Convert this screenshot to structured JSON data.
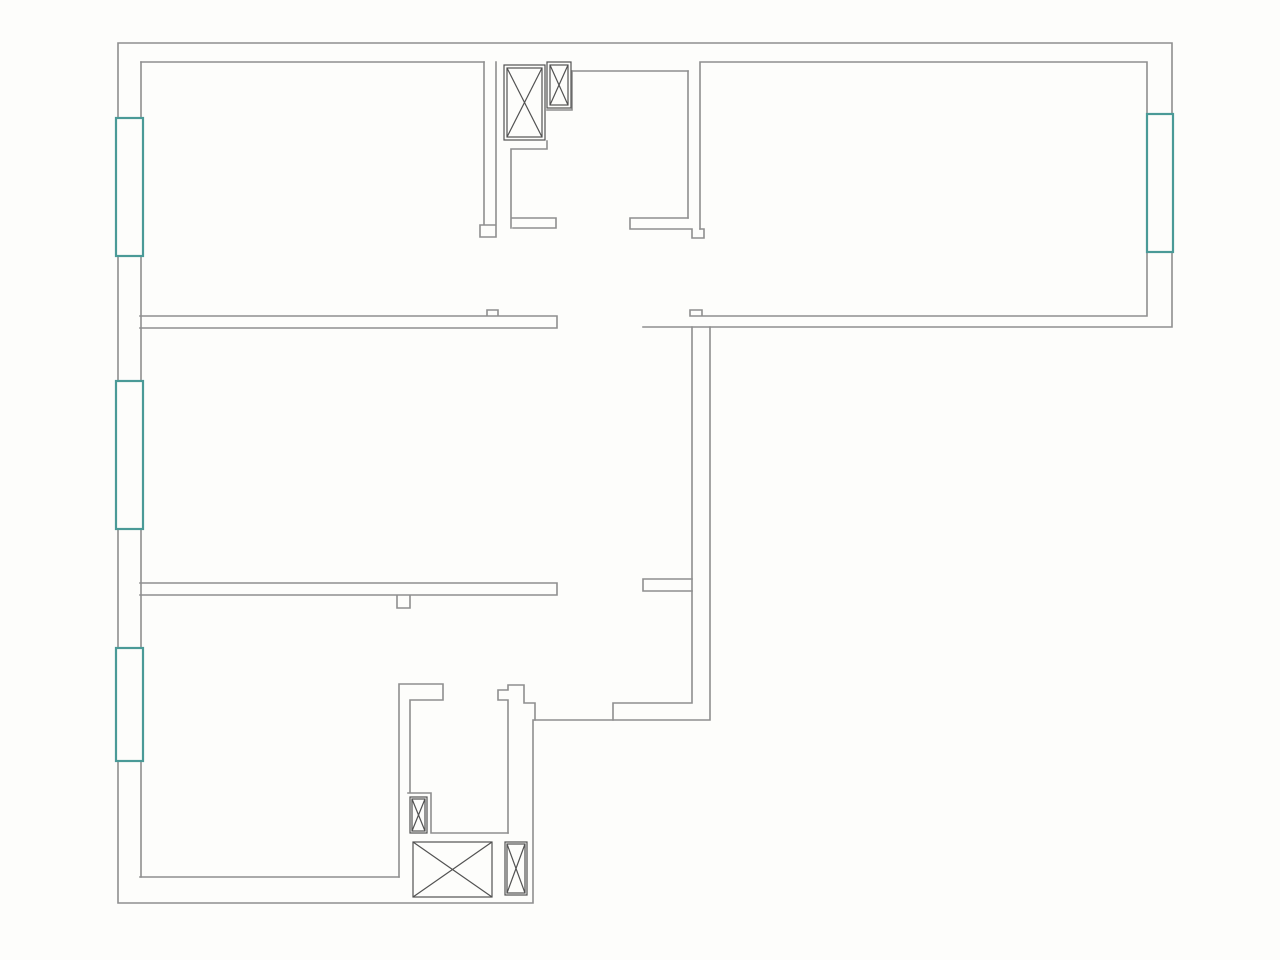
{
  "floorplan": {
    "title": "apartment-floor-plan",
    "canvas": {
      "width": 1280,
      "height": 960
    },
    "colors": {
      "background": "#fdfdfb",
      "wall": "#8f8f8f",
      "detail": "#525252",
      "window": "#4a9a97",
      "window_fill": "#fdfdfb"
    },
    "stroke_widths": {
      "wall": 1.6,
      "detail": 1.2,
      "window": 2.2
    },
    "outline": {
      "name": "apartment-outline",
      "d": "M118,43 L1172,43 L1172,327 L710,327 L710,720 L533,720 L533,903 L118,903 Z"
    },
    "walls": [
      {
        "name": "left-inner-wall",
        "d": "M141,62 L141,877"
      },
      {
        "name": "top-left-room-top-wall",
        "d": "M141,62 L484,62"
      },
      {
        "name": "top-left-room-right-wall",
        "d": "M484,62 L484,225 M496,62 L496,225 M496,225 L480,225 L480,237 L496,237 L496,225"
      },
      {
        "name": "wall-band-topleft-middle",
        "d": "M140,316 L557,316 M140,328 L557,328 M557,316 L557,328 M487,316 L487,310 L498,310 L498,316"
      },
      {
        "name": "wall-band-middle-bottom",
        "d": "M140,583 L557,583 M140,595 L557,595 M557,583 L557,595 M397,595 L397,608 L410,608 L410,595"
      },
      {
        "name": "bottom-room-bottom-wall",
        "d": "M140,877 L399,877"
      },
      {
        "name": "entry-niche-wall",
        "d": "M547,141 L547,149 M547,149 L511,149 M511,149 L511,228 M511,218 L556,218 M513,228 L556,228 M556,218 L556,228"
      },
      {
        "name": "entry-shaft-step-wall",
        "d": "M572,71 L572,110 M572,110 L547,110"
      },
      {
        "name": "entry-top-inner-wall",
        "d": "M572,71 L688,71"
      },
      {
        "name": "top-right-room-walls",
        "d": "M700,62 L1147,62 M1147,62 L1147,316 M690,316 L1147,316 M690,316 L690,310 L702,310 L702,316 M700,62 L700,229 M688,71 L688,218"
      },
      {
        "name": "top-right-room-door-jamb",
        "d": "M630,218 L688,218 M630,229 L692,229 M630,218 L630,229 M692,229 L692,238 L704,238 L704,229 L700,229"
      },
      {
        "name": "top-right-bottom-wall-stub",
        "d": "M643,327 L710,327"
      },
      {
        "name": "hall-right-wall-inner",
        "d": "M692,327 L692,703 M692,703 L613,703 M613,703 L613,720"
      },
      {
        "name": "hall-wall-arm",
        "d": "M643,579 L692,579 M643,591 L692,591 M643,579 L643,591"
      },
      {
        "name": "bathroom-left-wall",
        "d": "M399,684 L399,877 M399,684 L443,684 M443,684 L443,700 M443,700 L410,700 M410,700 L410,793 M408,793 L431,793 M431,793 L431,833 M431,833 L508,833"
      },
      {
        "name": "bathroom-right-wall",
        "d": "M535,720 L535,703 L524,703 L524,685 L508,685 L508,690 L498,690 L498,700 L508,700 L508,833"
      }
    ],
    "windows": [
      {
        "name": "window-top-left",
        "x": 116,
        "y": 118,
        "w": 27,
        "h": 138
      },
      {
        "name": "window-middle-left",
        "x": 116,
        "y": 381,
        "w": 27,
        "h": 148
      },
      {
        "name": "window-bottom-left",
        "x": 116,
        "y": 648,
        "w": 27,
        "h": 113
      },
      {
        "name": "window-right",
        "x": 1147,
        "y": 114,
        "w": 26,
        "h": 138
      }
    ],
    "shafts": [
      {
        "name": "shaft-box-entry-large",
        "x": 504,
        "y": 65,
        "w": 41,
        "h": 75,
        "inset": 3
      },
      {
        "name": "shaft-box-entry-small",
        "x": 547,
        "y": 62,
        "w": 24,
        "h": 46,
        "inset": 3
      },
      {
        "name": "shaft-box-bath-small",
        "x": 410,
        "y": 797,
        "w": 17,
        "h": 36,
        "inset": 2
      },
      {
        "name": "shaft-box-bottom-large",
        "x": 413,
        "y": 842,
        "w": 79,
        "h": 55,
        "inset": 0
      },
      {
        "name": "shaft-box-bottom-narrow",
        "x": 505,
        "y": 842,
        "w": 22,
        "h": 53,
        "inset": 2
      }
    ]
  }
}
